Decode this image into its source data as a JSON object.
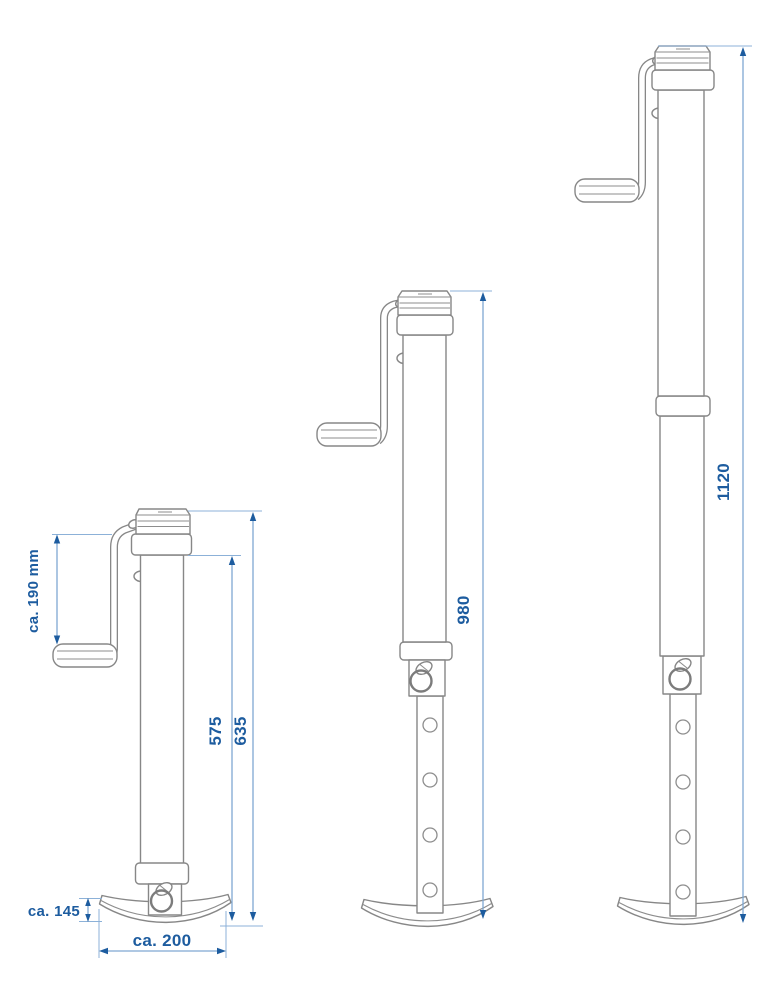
{
  "diagram": {
    "type": "technical-drawing",
    "subject": "telescopic trailer support jack shown in three extension lengths",
    "colors": {
      "background": "#ffffff",
      "drawing_line": "#878787",
      "dimension_line": "#7fa8d2",
      "dimension_text": "#1d5c9f"
    },
    "labels": {
      "crank_offset": "ca. 190 mm",
      "small_inner_height": "575",
      "small_total_height": "635",
      "foot_height": "ca. 145",
      "foot_width": "ca. 200",
      "medium_total_height": "980",
      "large_total_height": "1120"
    }
  }
}
